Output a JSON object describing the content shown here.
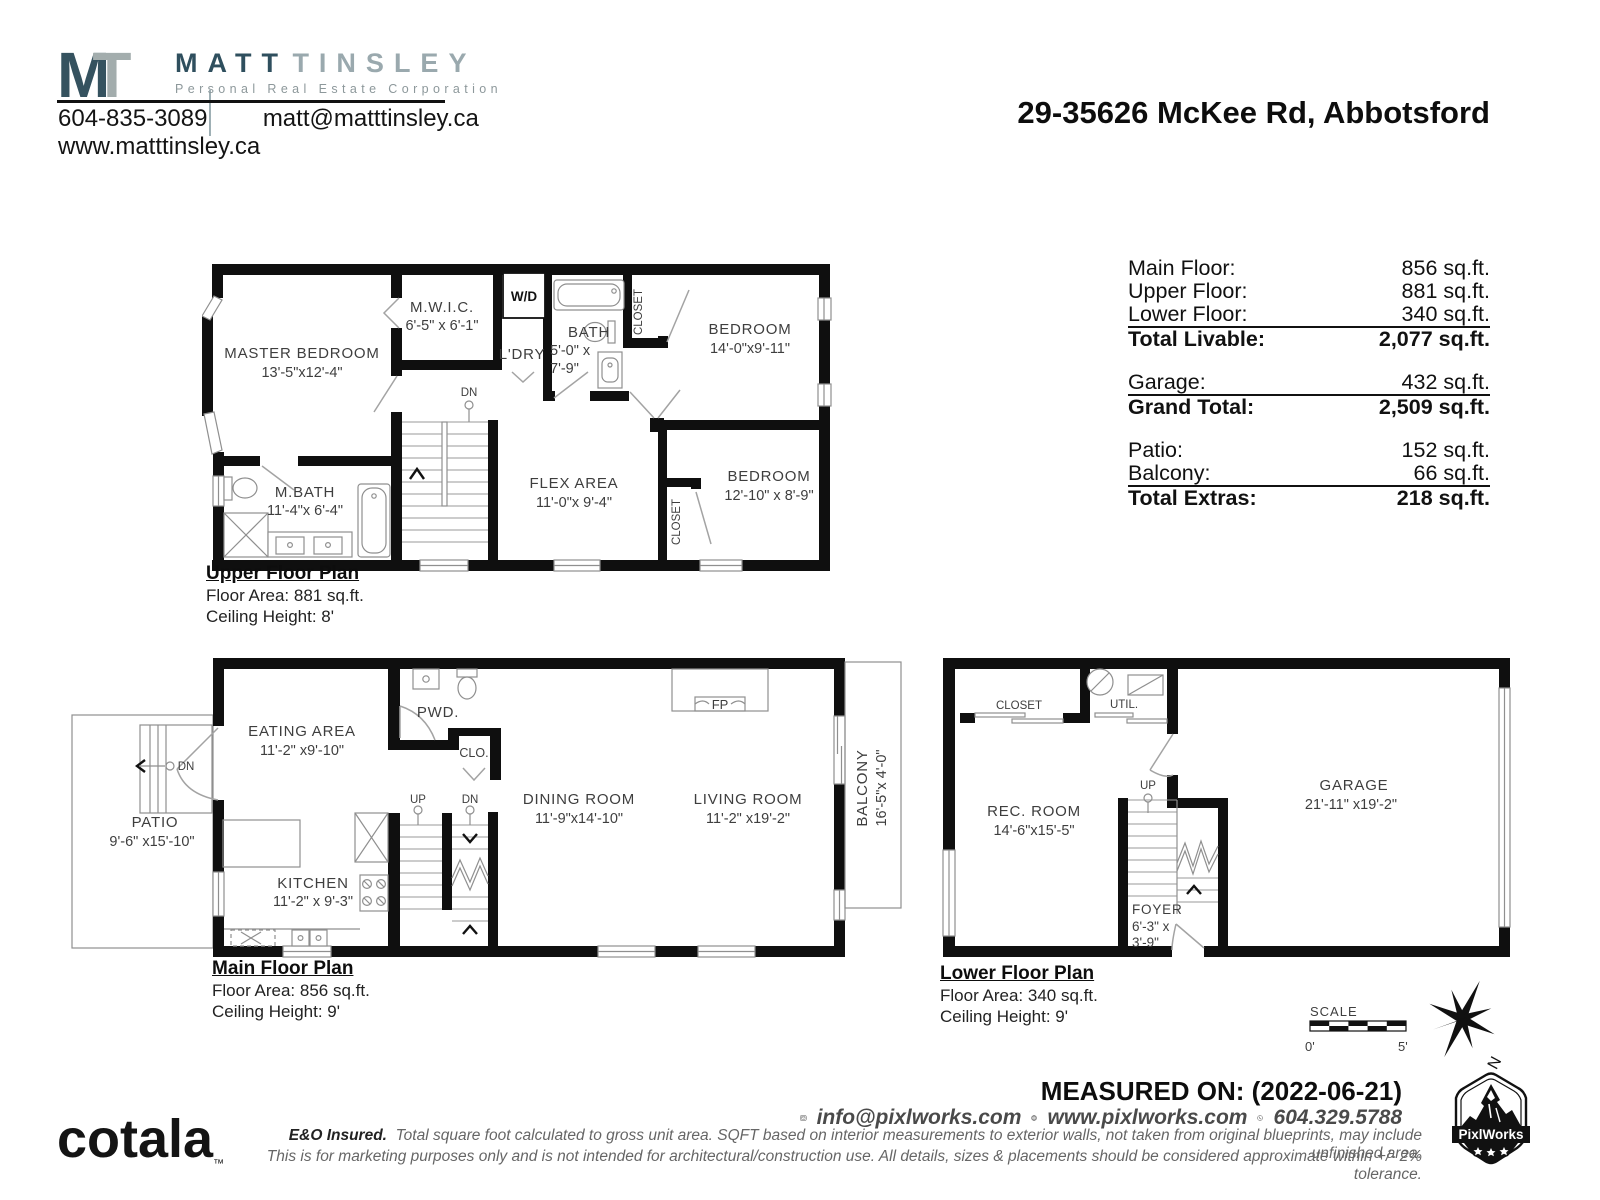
{
  "page": {
    "address": "29-35626 McKee Rd, Abbotsford"
  },
  "agent": {
    "logo_m": "M",
    "logo_t": "T",
    "name_first": "MATT",
    "name_last": "TINSLEY",
    "subtitle": "Personal Real Estate Corporation",
    "phone": "604-835-3089",
    "email": "matt@matttinsley.ca",
    "website": "www.matttinsley.ca"
  },
  "area_summary": {
    "rows": [
      {
        "label": "Main Floor:",
        "value": "856 sq.ft."
      },
      {
        "label": "Upper Floor:",
        "value": "881 sq.ft."
      },
      {
        "label": "Lower Floor:",
        "value": "340 sq.ft."
      },
      {
        "label": "Total Livable:",
        "value": "2,077 sq.ft."
      },
      {
        "label": "Garage:",
        "value": "432 sq.ft."
      },
      {
        "label": "Grand Total:",
        "value": "2,509 sq.ft."
      },
      {
        "label": "Patio:",
        "value": "152 sq.ft."
      },
      {
        "label": "Balcony:",
        "value": "66 sq.ft."
      },
      {
        "label": "Total Extras:",
        "value": "218 sq.ft."
      }
    ]
  },
  "upper_floor": {
    "caption_title": "Upper Floor Plan",
    "caption_area": "Floor Area: 881 sq.ft.",
    "caption_ceiling": "Ceiling Height: 8'",
    "master_name": "MASTER BEDROOM",
    "master_dims": "13'-5\"x12'-4\"",
    "mwic_name": "M.W.I.C.",
    "mwic_dims": "6'-5\" x 6'-1\"",
    "wd": "W/D",
    "ldry": "L'DRY",
    "bath_name": "BATH",
    "bath_dims1": "5'-0\" x",
    "bath_dims2": "7'-9\"",
    "closet_top": "CLOSET",
    "bedroom1_name": "BEDROOM",
    "bedroom1_dims": "14'-0\"x9'-11\"",
    "dn": "DN",
    "mbath_name": "M.BATH",
    "mbath_dims": "11'-4\"x 6'-4\"",
    "flex_name": "FLEX AREA",
    "flex_dims": "11'-0\"x 9'-4\"",
    "bedroom2_name": "BEDROOM",
    "bedroom2_dims": "12'-10\" x 8'-9\"",
    "closet_bottom": "CLOSET"
  },
  "main_floor": {
    "caption_title": "Main Floor Plan",
    "caption_area": "Floor Area: 856 sq.ft.",
    "caption_ceiling": "Ceiling Height: 9'",
    "patio_name": "PATIO",
    "patio_dims": "9'-6\" x15'-10\"",
    "dn_patio": "DN",
    "eating_name": "EATING AREA",
    "eating_dims": "11'-2\" x9'-10\"",
    "pwd": "PWD.",
    "clo": "CLO.",
    "kitchen_name": "KITCHEN",
    "kitchen_dims": "11'-2\" x 9'-3\"",
    "up": "UP",
    "dn": "DN",
    "dining_name": "DINING ROOM",
    "dining_dims": "11'-9\"x14'-10\"",
    "living_name": "LIVING ROOM",
    "living_dims": "11'-2\" x19'-2\"",
    "fp": "FP",
    "balcony_name": "BALCONY",
    "balcony_dims": "16'-5\"x 4'-0\""
  },
  "lower_floor": {
    "caption_title": "Lower Floor Plan",
    "caption_area": "Floor Area: 340 sq.ft.",
    "caption_ceiling": "Ceiling Height: 9'",
    "closet": "CLOSET",
    "util": "UTIL.",
    "rec_name": "REC. ROOM",
    "rec_dims": "14'-6\"x15'-5\"",
    "up": "UP",
    "foyer_name": "FOYER",
    "foyer_dims1": "6'-3\" x",
    "foyer_dims2": "3'-9\"",
    "garage_name": "GARAGE",
    "garage_dims": "21'-11\" x19'-2\""
  },
  "scale_bar": {
    "label": "SCALE",
    "start": "0'",
    "end": "5'",
    "north": "N"
  },
  "footer": {
    "measured_on": "MEASURED ON: (2022-06-21)",
    "email": "info@pixlworks.com",
    "website": "www.pixlworks.com",
    "phone": "604.329.5788",
    "cotala": "cotala",
    "tm": "™",
    "disclaimer1_lead": "E&O Insured.",
    "disclaimer1": "Total square foot calculated to gross unit area. SQFT based on interior measurements to exterior walls, not taken from original blueprints, may include unfinished area.",
    "disclaimer2": "This is for marketing purposes only and is not intended for architectural/construction use.  All details, sizes & placements should be considered approximate within +/- 2%  tolerance.",
    "pixlworks": "PixlWorks"
  },
  "colors": {
    "brand_dark": "#2f4f5e",
    "brand_gray": "#9aa9ae",
    "wall_black": "#0f0f0f",
    "thin_line": "#8f8f8f",
    "label_gray": "#3e3e3e"
  }
}
